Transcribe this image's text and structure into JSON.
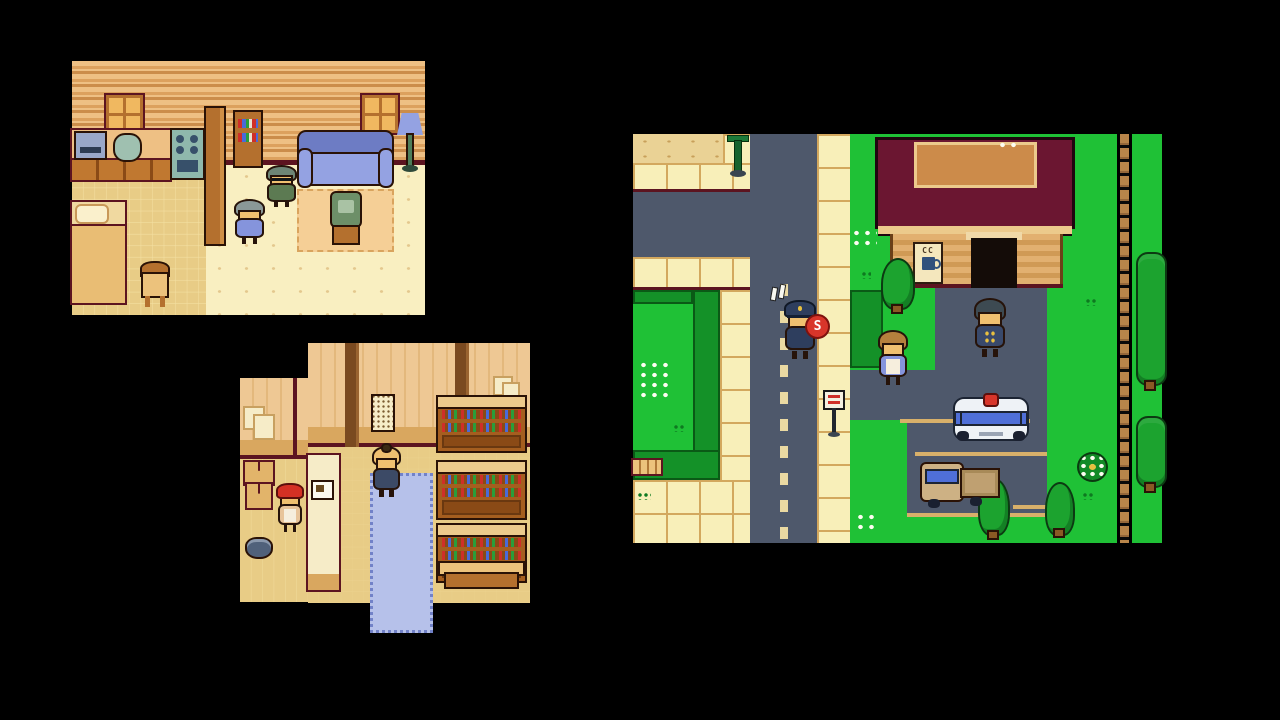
{
  "scene": {
    "type": "pixel-art RPG screenshot, three game viewports on black",
    "background": "#000000",
    "panels": [
      {
        "id": "house-interior",
        "title": "House interior scene",
        "entities": [
          "window",
          "window",
          "kitchen-counter",
          "radio",
          "sink",
          "stove",
          "room-divider",
          "bookshelf",
          "sofa",
          "floor-lamp",
          "rug",
          "television",
          "old-man-npc",
          "old-woman-npc",
          "bed",
          "chair"
        ]
      },
      {
        "id": "shop-interior",
        "title": "Shop interior scene",
        "entities": [
          "wall-poster",
          "notice-papers",
          "wall-frames",
          "goods-shelf",
          "goods-shelf",
          "goods-shelf",
          "entrance-mat",
          "customer-npc",
          "checkout-counter",
          "shopkeeper-npc",
          "cardboard-boxes",
          "pot",
          "bench"
        ]
      },
      {
        "id": "town-street",
        "title": "Town street scene with cafe and parking lot",
        "entities": [
          "lamppost",
          "roads",
          "sidewalks",
          "park-hedge",
          "park-bench",
          "street-sign",
          "cafe-building",
          "cafe-door",
          "cafe-sign",
          "police-officer-npc",
          "stop-paddle",
          "pedestrian-npc",
          "villager-npc",
          "police-car",
          "pickup-truck",
          "trees",
          "flower-bed",
          "dirt-path",
          "flowers"
        ]
      }
    ]
  },
  "labels": {
    "stop_paddle": "S",
    "cafe_sign_steam": "CC"
  },
  "palette": {
    "bg": "#000000",
    "roadGray": "#4e586b",
    "sidewalkCream": "#f8efb9",
    "tileLine": "#d3a85e",
    "maroonEdge": "#5c1420",
    "grassGreen": "#1fc136",
    "hedgeGreen": "#149128",
    "hedgeDark": "#0a5a16",
    "treeGreen": "#1ca32f",
    "treeOutline": "#0c3a12",
    "trunkBrown": "#8a5a24",
    "sandTan": "#ead295",
    "sandSpeck": "#c8a05a",
    "wallLight": "#eec084",
    "wallMid": "#dca15e",
    "wallDark": "#cb8d4b",
    "floorCream": "#f9efc1",
    "floorDot": "#e4c88e",
    "checkLight": "#f4e0a2",
    "checkDark": "#e8cc86",
    "woodBrown": "#b4702e",
    "woodDark": "#7a4012",
    "outlineDark": "#2a1206",
    "couchBlue": "#94a2e2",
    "couchBlueDark": "#6d7cc4",
    "lampGreen": "#4e7e5a",
    "stoveTeal": "#8fb8ac",
    "applianceSlate": "#9aa8c8",
    "sinkTeal": "#9fc0b0",
    "tvGreen": "#6d8f68",
    "tvScreen": "#a9c2a4",
    "rugPeach": "#f5cf96",
    "rugLine": "#d9a45e",
    "matBlue": "#b6c1ea",
    "matBorder": "#7282c8",
    "shopWallA": "#eec894",
    "shopWallB": "#e3b87c",
    "shopBand": "#d9a75f",
    "pillarBrown": "#7a4a20",
    "shelfBrown": "#a55e1f",
    "shelfTop": "#ecca8c",
    "shelfBase": "#8a4a16",
    "bottleRed": "#cf2f28",
    "bottleGreen": "#2a9e3a",
    "bottleBlue": "#4a6ad8",
    "counterCream": "#f6ecc8",
    "roofMaroon": "#6b1631",
    "roofOrange": "#cc8b4a",
    "eaveTan": "#ecca8c",
    "cafeWallA": "#e2b070",
    "cafeWallB": "#d09a55",
    "doorBlack": "#140c08",
    "signCream": "#f4e7bd",
    "mugNavy": "#31517c",
    "paddleRed": "#d8352a",
    "copNavy": "#2e3e5e",
    "skinTan": "#f0c070",
    "carWhite": "#eef2f6",
    "carOutline": "#1c2433",
    "windowBlue": "#4f6fd8",
    "lightRed": "#d8352a",
    "truckTan": "#cdb184",
    "truckBed": "#bfa071",
    "capRed": "#d43024",
    "apronWhite": "#f6eedd",
    "badgeGold": "#e8c040",
    "hairGray": "#8a9898",
    "hairGreenGray": "#6e8576",
    "hairBrown": "#b5803d",
    "hairSlate": "#3d4a52",
    "hairNavyKid": "#3c4a66",
    "dressBlue": "#8594dc",
    "jacketGreen": "#5c7a52",
    "villagerNavy": "#39496b",
    "lotLine": "#d8b06a",
    "pathBrown": "#b8854a",
    "pathDark": "#96683a",
    "dashCream": "#ead9a2",
    "alertWhite": "#f8f8f0",
    "benchTan": "#ecc27c"
  }
}
